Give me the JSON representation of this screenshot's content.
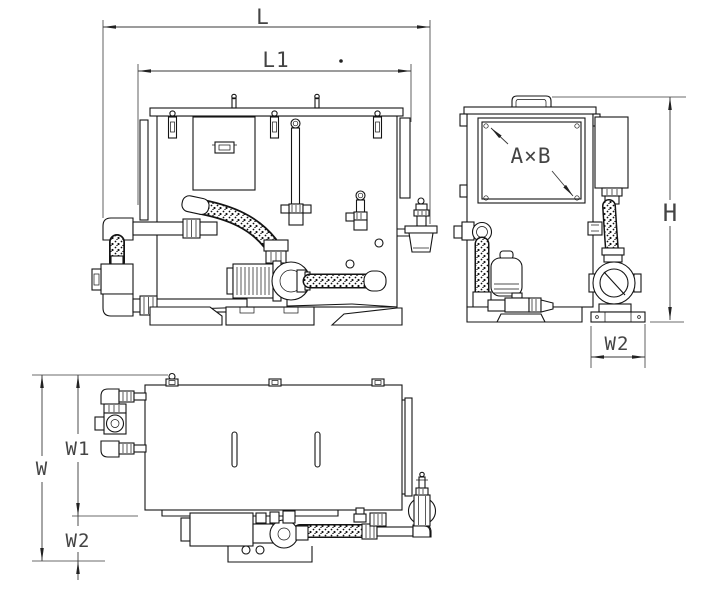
{
  "drawing": {
    "kind": "technical-drawing-three-views",
    "labels": {
      "L": "L",
      "L1": "L1",
      "H": "H",
      "W": "W",
      "W1": "W1",
      "W2_plan": "W2",
      "W2_side": "W2",
      "AxB": "A×B"
    },
    "colors": {
      "line": "#141414",
      "dimension": "#3a3a3a",
      "background": "#ffffff"
    }
  }
}
